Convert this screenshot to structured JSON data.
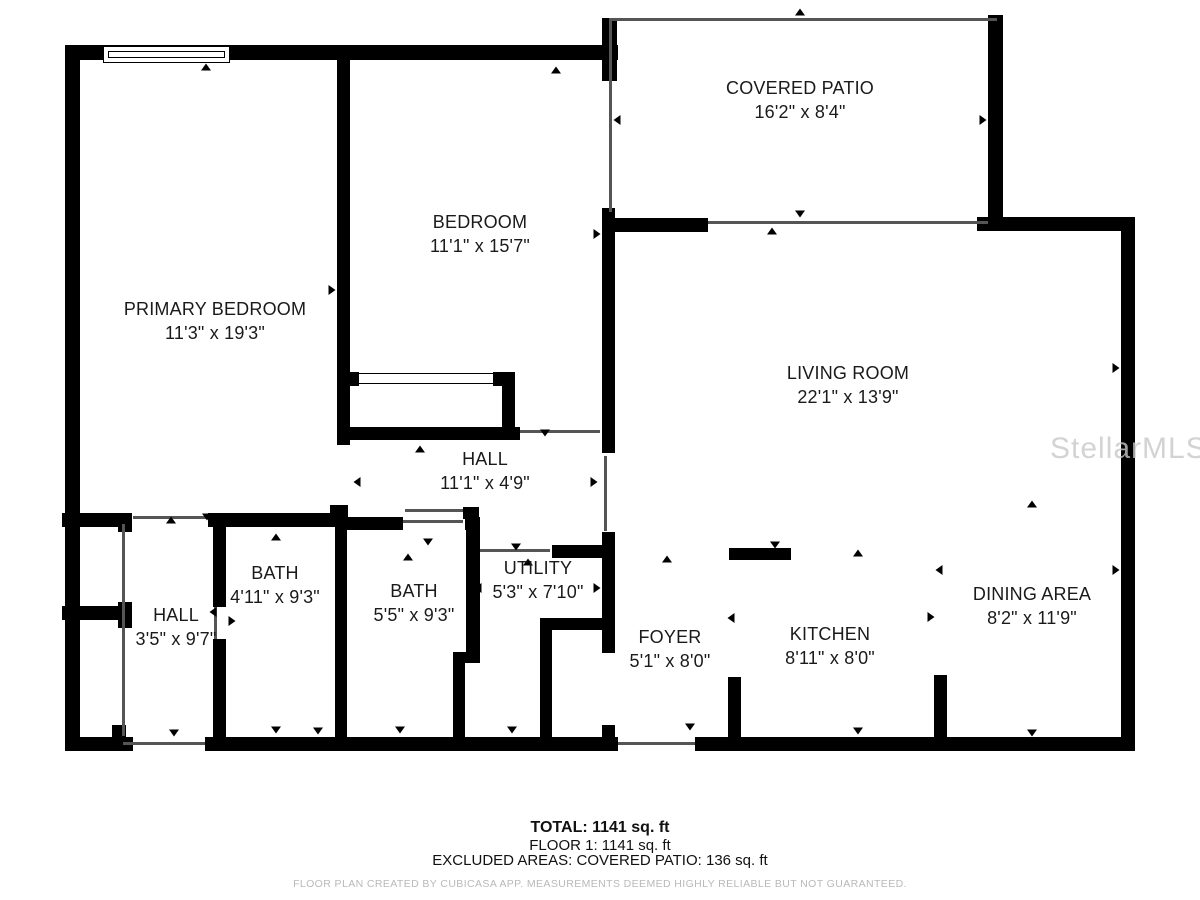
{
  "title": "Floor plan - Floor 1",
  "watermark": "StellarMLS",
  "rooms": [
    {
      "id": "covered-patio",
      "name": "COVERED PATIO",
      "dims": "16'2\" x 8'4\""
    },
    {
      "id": "bedroom",
      "name": "BEDROOM",
      "dims": "11'1\" x 15'7\""
    },
    {
      "id": "primary-bedroom",
      "name": "PRIMARY BEDROOM",
      "dims": "11'3\" x 19'3\""
    },
    {
      "id": "living-room",
      "name": "LIVING ROOM",
      "dims": "22'1\" x 13'9\""
    },
    {
      "id": "hall-upper",
      "name": "HALL",
      "dims": "11'1\" x 4'9\""
    },
    {
      "id": "bath-1",
      "name": "BATH",
      "dims": "4'11\" x 9'3\""
    },
    {
      "id": "bath-2",
      "name": "BATH",
      "dims": "5'5\" x 9'3\""
    },
    {
      "id": "utility",
      "name": "UTILITY",
      "dims": "5'3\" x 7'10\""
    },
    {
      "id": "hall-lower",
      "name": "HALL",
      "dims": "3'5\" x 9'7\""
    },
    {
      "id": "foyer",
      "name": "FOYER",
      "dims": "5'1\" x 8'0\""
    },
    {
      "id": "kitchen",
      "name": "KITCHEN",
      "dims": "8'11\" x 8'0\""
    },
    {
      "id": "dining-area",
      "name": "DINING AREA",
      "dims": "8'2\" x 11'9\""
    }
  ],
  "summary": {
    "total": "TOTAL: 1141 sq. ft",
    "floor": "FLOOR 1: 1141 sq. ft",
    "excluded": "EXCLUDED AREAS: COVERED PATIO: 136 sq. ft",
    "disclaimer": "FLOOR PLAN CREATED BY CUBICASA APP. MEASUREMENTS DEEMED HIGHLY RELIABLE BUT NOT GUARANTEED."
  },
  "colors": {
    "wall": "#000000",
    "background": "#ffffff",
    "label": "#1a1a1a",
    "disclaimer_text": "#b9b9b9",
    "watermark_text": "#c9c9c9"
  }
}
